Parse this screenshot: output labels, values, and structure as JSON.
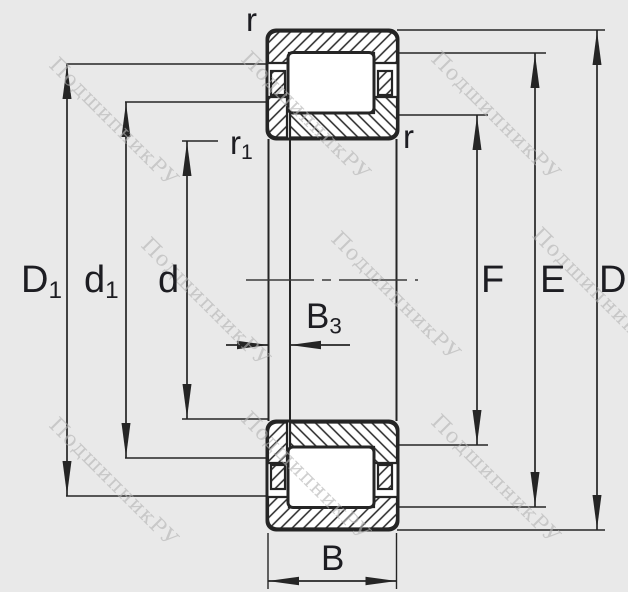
{
  "colors": {
    "background": "#e9e9e9",
    "line": "#252525",
    "label": "#1d1d22",
    "watermark": "#b4b4b4"
  },
  "watermark": {
    "text": "ПодшипникРУ"
  },
  "labels": {
    "r_top": "r",
    "r_right": "r",
    "r1_main": "r",
    "r1_sub": "1",
    "D1_main": "D",
    "D1_sub": "1",
    "d1_main": "d",
    "d1_sub": "1",
    "d": "d",
    "B3_main": "B",
    "B3_sub": "3",
    "F": "F",
    "E": "E",
    "D": "D",
    "B": "B"
  }
}
